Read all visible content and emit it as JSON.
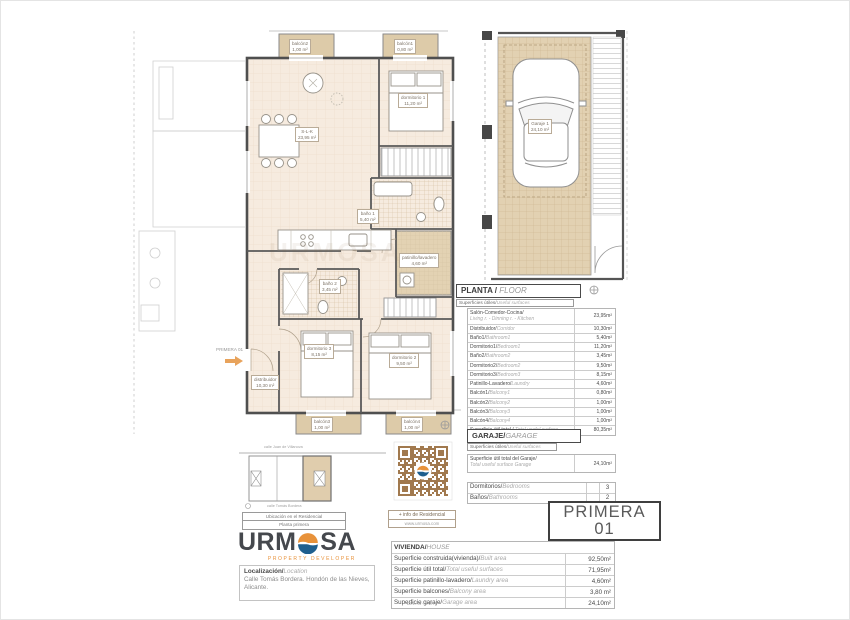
{
  "brand": {
    "name": "URMOSA",
    "tagline": "PROPERTY DEVELOPER"
  },
  "plan": {
    "entry_label": "PRIMERA 01",
    "rooms": {
      "slk": {
        "name": "S-L-K",
        "area": "23,95 m²"
      },
      "dorm1": {
        "name": "dormitorio 1",
        "area": "11,20 m²"
      },
      "dorm2": {
        "name": "dormitorio 2",
        "area": "9,50 m²"
      },
      "dorm3": {
        "name": "dormitorio 3",
        "area": "8,15 m²"
      },
      "bath1": {
        "name": "baño 1",
        "area": "5,40 m²"
      },
      "bath2": {
        "name": "baño 2",
        "area": "3,45 m²"
      },
      "corridor": {
        "name": "distribuidor",
        "area": "10,30 m²"
      },
      "laundry": {
        "name": "patinillo/lavadero",
        "area": "4,60 m²"
      },
      "balcony1": {
        "name": "balcón1",
        "area": "0,80 m²"
      },
      "balcony2": {
        "name": "balcón2",
        "area": "1,00 m²"
      },
      "balcony3": {
        "name": "balcón3",
        "area": "1,00 m²"
      },
      "balcony4": {
        "name": "balcón4",
        "area": "1,00 m²"
      }
    }
  },
  "garage_plan": {
    "name": "Garaje 1",
    "area": "24,10 m²"
  },
  "floor_table": {
    "title_es": "PLANTA / ",
    "title_en": "FLOOR",
    "subtitle_es": "Superficies útiles/",
    "subtitle_en": "Useful surfaces",
    "rows": [
      {
        "es": "Salón-Comedor-Cocina/",
        "en": "Living r. - Dinning r. - Kitchen",
        "value": "23,95m²"
      },
      {
        "es": "Distribuidor/",
        "en": "Corridor",
        "value": "10,30m²"
      },
      {
        "es": "Baño1/",
        "en": "Bathroom1",
        "value": "5,40m²"
      },
      {
        "es": "Dormitorio1/",
        "en": "Bedroom1",
        "value": "11,20m²"
      },
      {
        "es": "Baño2/",
        "en": "Bathroom2",
        "value": "3,45m²"
      },
      {
        "es": "Dormitorio2/",
        "en": "Bedroom2",
        "value": "9,50m²"
      },
      {
        "es": "Dormitorio3/",
        "en": "Bedroom3",
        "value": "8,15m²"
      },
      {
        "es": "Patinillo-Lavadero/",
        "en": "Laundry",
        "value": "4,60m²"
      },
      {
        "es": "Balcón1/",
        "en": "Balcony1",
        "value": "0,80m²"
      },
      {
        "es": "Balcón2/",
        "en": "Balcony2",
        "value": "1,00m²"
      },
      {
        "es": "Balcón3/",
        "en": "Balcony3",
        "value": "1,00m²"
      },
      {
        "es": "Balcón4/",
        "en": "Balcony4",
        "value": "1,00m²"
      },
      {
        "es": "Superficie útil total / ",
        "en": "Total useful surface",
        "value": "80,35m²"
      }
    ]
  },
  "garage_table": {
    "title_es": "GARAJE/",
    "title_en": "GARAGE",
    "subtitle_es": "Superficies útiles/",
    "subtitle_en": "Useful surfaces",
    "row_es": "Superficie útil total del Garaje/",
    "row_en": "Total useful surface Garage",
    "row_value": "24,10m²"
  },
  "counts": {
    "rows": [
      {
        "es": "Dormitorios/",
        "en": "Bedrooms",
        "value": "3"
      },
      {
        "es": "Baños/",
        "en": "Bathrooms",
        "value": "2"
      }
    ]
  },
  "unit_badge": {
    "line1": "PRIMERA",
    "line2": "01"
  },
  "house_table": {
    "title_es": "VIVIENDA/",
    "title_en": "HOUSE",
    "rows": [
      {
        "es": "Superficie construida(vivienda)/",
        "en": "Built area",
        "value": "92,50m²"
      },
      {
        "es": "Superficie útil total/",
        "en": "Total useful surfaces",
        "value": "71,95m²"
      },
      {
        "es": "Superficie patinillo-lavadero/",
        "en": "Laundry area",
        "value": "4,60m²"
      },
      {
        "es": "Superficie balcones/",
        "en": "Balcony area",
        "value": "3,80 m²"
      },
      {
        "es": "Superficie garaje/",
        "en": "Garage area",
        "value": "24,10m²"
      }
    ],
    "note": "DIN A4 - e:1/75"
  },
  "site_plan": {
    "street_top": "calle Juan de Villanova",
    "street_bottom": "calle Tomás Bordera",
    "caption1": "Ubicación en el Residencial",
    "caption2": "Planta primera"
  },
  "location": {
    "label_es": "Localización/",
    "label_en": "Location",
    "address": "Calle Tomás Bordera. Hondón de las Nieves, Alicante."
  },
  "qr": {
    "caption1": "+ info de Residencial",
    "caption2": "www.urmosa.com"
  },
  "colors": {
    "accent_orange": "#e8923a",
    "logo_blue": "#1f5f8e",
    "qr_brown": "#a1794e",
    "room_fill": "#f6ebdf",
    "tan_fill": "#ddcba9"
  }
}
